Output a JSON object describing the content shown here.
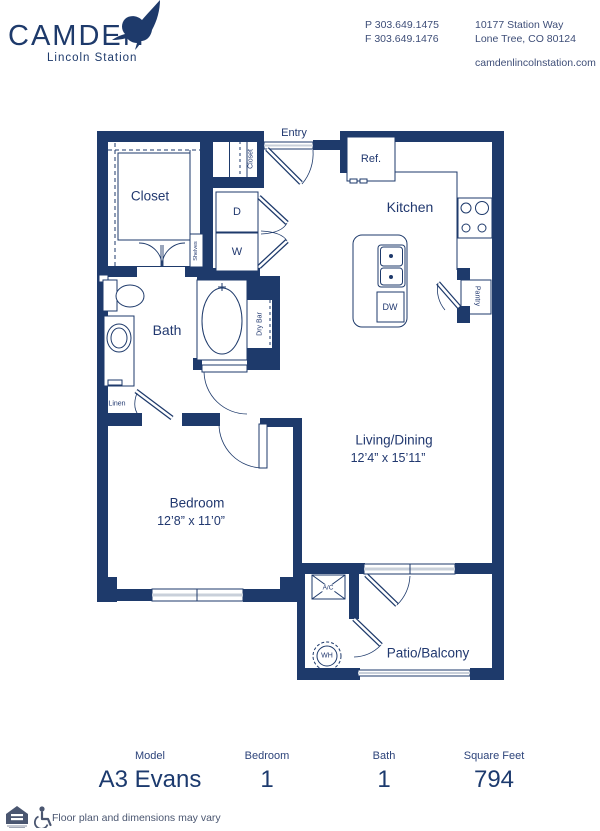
{
  "header": {
    "brand": "CAMDEN",
    "brand_sub": "Lincoln Station",
    "phone1": "P 303.649.1475",
    "phone2": "F 303.649.1476",
    "addr1": "10177 Station Way",
    "addr2": "Lone Tree, CO 80124",
    "website": "camdenlincolnstation.com"
  },
  "colors": {
    "wall_navy": "#1e3a6b",
    "label_navy": "#21386f",
    "window_gray": "#c9d0da",
    "muted_gray": "#4a5670"
  },
  "floorplan": {
    "rooms": {
      "closet": "Closet",
      "entry": "Entry",
      "kitchen": "Kitchen",
      "bath": "Bath",
      "living_title": "Living/Dining",
      "living_dims": "12’4” x 15’11”",
      "bedroom_title": "Bedroom",
      "bedroom_dims": "12’8” x 11’0”",
      "patio": "Patio/Balcony"
    },
    "fixtures": {
      "ref": "Ref.",
      "dryer": "D",
      "washer": "W",
      "dw": "DW",
      "dry_bar": "Dry Bar",
      "linen": "Linen",
      "pantry": "Pantry",
      "shelves": "Shelves",
      "entry_closet": "Closet",
      "ac": "A/C",
      "wh": "WH"
    }
  },
  "summary": {
    "columns": [
      {
        "label": "Model",
        "value": "A3 Evans"
      },
      {
        "label": "Bedroom",
        "value": "1"
      },
      {
        "label": "Bath",
        "value": "1"
      },
      {
        "label": "Square Feet",
        "value": "794"
      }
    ]
  },
  "footnote": "Floor plan and dimensions may vary"
}
